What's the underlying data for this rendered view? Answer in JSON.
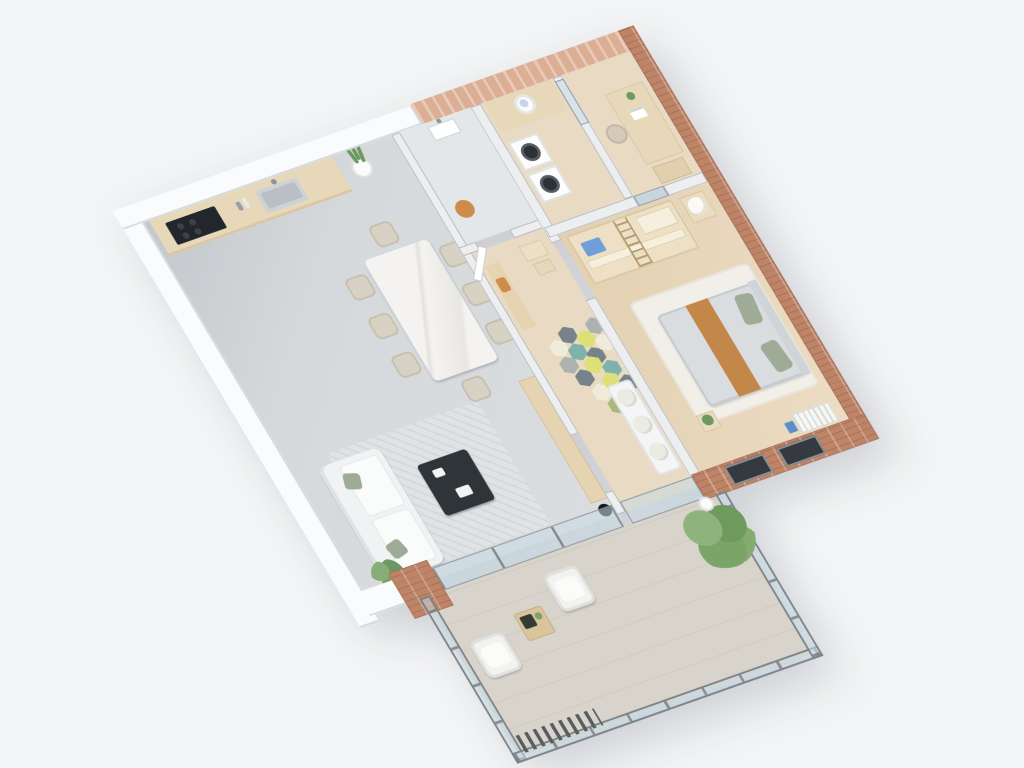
{
  "scene": {
    "description": "Isometric 3D render of an apartment floor plan with open living-dining-kitchen, hallway with hexagonal accent tiles, bathroom, laundry room, home office, bedroom and a glass-railed balcony; terracotta brick exterior walls on the top-right and bottom-right, white walls elsewhere",
    "view": "axonometric from above, rotated",
    "background_color": "#f4f5f6"
  },
  "colors": {
    "background": "#f4f5f6",
    "wall_white": "#fafbfc",
    "wall_gray": "#eceef0",
    "wall_edge": "#b4bac0",
    "brick": "#bd8468",
    "brick_dark": "#aa7157",
    "brick_light": "#dcae94",
    "floor_living": "#d5d8db",
    "floor_wood": "#e9dac3",
    "floor_bath": "#e4e7e9",
    "floor_balcony": "#d8d4cc",
    "glass": "rgba(199,219,228,0.55)",
    "railing": "#7c8287",
    "counter": "#e8d8ba",
    "cooktop": "#23272b",
    "sofa": "#f1f2f3",
    "pillow_green": "#9dab97",
    "rug": "#e0e3e5",
    "rug_bedroom": "#f2efe8",
    "table_white": "#f4f3f1",
    "chair_beige": "#d8d2c4",
    "coffee_table": "#2f3438",
    "wood_furniture": "#e5d3b2",
    "bed_duvet": "#d9dde0",
    "bed_stripe": "#c4874a",
    "lamp_black": "#17191b",
    "plant_green": "#6d9861",
    "stool_orange": "#cf8b4a",
    "machine_door": "#2c3135",
    "window_dark": "#343a3f",
    "hex_palette": [
      "#78828b",
      "#aeb2ae",
      "#dde077",
      "#7fb2ad",
      "#f1ebdb",
      "#a8b87e"
    ]
  },
  "rooms": {
    "living": {
      "label": "Open living / dining / kitchen",
      "furniture": [
        "kitchen counter with cooktop and sink",
        "snake plant",
        "marble dining table with 8 beige chairs",
        "white sofa with green pillows",
        "gray rug",
        "dark coffee table",
        "wood sideboard",
        "black floor lamp",
        "palm plant"
      ]
    },
    "hallway": {
      "label": "Hallway with hexagonal tiles",
      "furniture": [
        "wood console with orange coat",
        "storage boxes",
        "white cushioned bench",
        "hex tile cluster"
      ]
    },
    "bathroom": {
      "label": "Bathroom",
      "furniture": [
        "wall-hung sink",
        "orange stool"
      ]
    },
    "laundry": {
      "label": "Laundry room",
      "furniture": [
        "counter with laundry basket",
        "washer",
        "dryer"
      ]
    },
    "office": {
      "label": "Home office",
      "furniture": [
        "desk with laptop",
        "chair",
        "drawer unit",
        "glass door"
      ]
    },
    "bedroom": {
      "label": "Bedroom",
      "furniture": [
        "double bed with orange throw and green pillows",
        "white rug",
        "open wardrobe shelving with ladder",
        "ball lamp on stand",
        "plant nightstand",
        "radiator",
        "blue books"
      ]
    },
    "balcony": {
      "label": "Balcony with glass railing",
      "furniture": [
        "two white armchairs",
        "wood side table with dark tray",
        "large green bush",
        "potted plant"
      ]
    }
  },
  "hallway": {
    "hex_tiles": [
      {
        "x": 336,
        "y": 272,
        "c": 4
      },
      {
        "x": 352,
        "y": 262,
        "c": 0
      },
      {
        "x": 368,
        "y": 272,
        "c": 2
      },
      {
        "x": 384,
        "y": 262,
        "c": 1
      },
      {
        "x": 336,
        "y": 292,
        "c": 1
      },
      {
        "x": 352,
        "y": 282,
        "c": 3
      },
      {
        "x": 368,
        "y": 292,
        "c": 0
      },
      {
        "x": 384,
        "y": 282,
        "c": 4
      },
      {
        "x": 344,
        "y": 310,
        "c": 0
      },
      {
        "x": 360,
        "y": 300,
        "c": 2
      },
      {
        "x": 376,
        "y": 310,
        "c": 3
      },
      {
        "x": 352,
        "y": 330,
        "c": 4
      },
      {
        "x": 368,
        "y": 322,
        "c": 2
      },
      {
        "x": 384,
        "y": 330,
        "c": 0
      },
      {
        "x": 360,
        "y": 348,
        "c": 5
      },
      {
        "x": 376,
        "y": 344,
        "c": 4
      }
    ]
  },
  "dining": {
    "chairs": [
      {
        "x": 174,
        "y": 140
      },
      {
        "x": 174,
        "y": 186
      },
      {
        "x": 174,
        "y": 232
      },
      {
        "x": 284,
        "y": 140
      },
      {
        "x": 284,
        "y": 186
      },
      {
        "x": 284,
        "y": 232
      },
      {
        "x": 228,
        "y": 96
      },
      {
        "x": 228,
        "y": 280
      }
    ]
  }
}
